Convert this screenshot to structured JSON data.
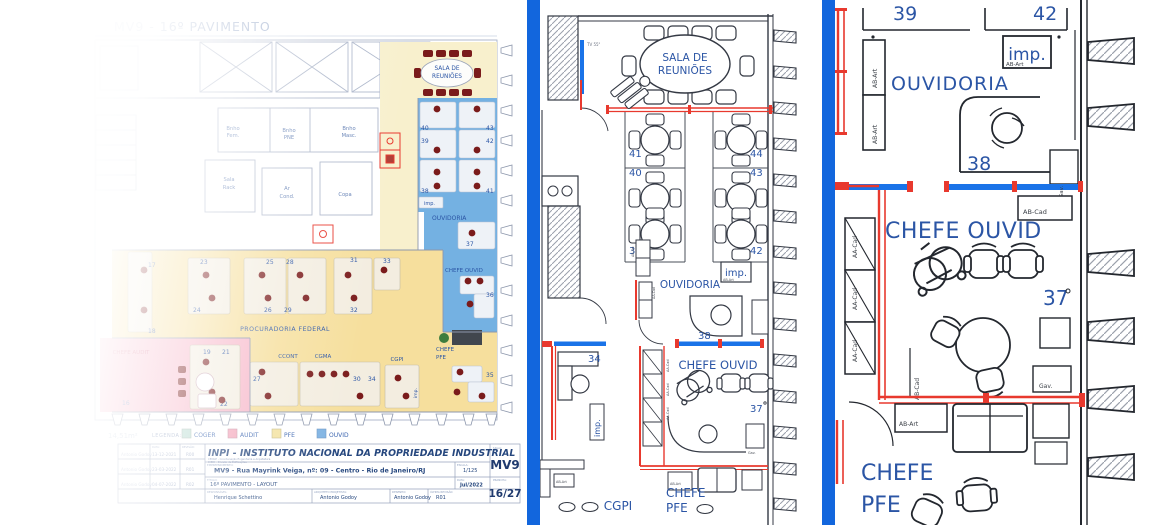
{
  "colors": {
    "divider": "#1266dd",
    "wall_red": "#e8392e",
    "glass_blue": "#1a73e8",
    "text_blue": "#2b55a5",
    "zone_ouvid": "#74b1e2",
    "zone_pfe": "#f6df9d",
    "zone_audit": "#f7b7c9",
    "zone_cream": "#f8f0cd",
    "chair_dark": "#7a1b1b"
  },
  "codes": {
    "imp": "imp.",
    "aa_cad": "AA-Cad",
    "ab_cad": "AB-Cad",
    "ab_art": "AB-Art",
    "gav": "Gav.",
    "tv": "TV 55\""
  },
  "left": {
    "header": "MV9 - 16º PAVIMENTO",
    "labels": {
      "sala_reunioes_1": "SALA DE",
      "sala_reunioes_2": "REUNIÕES",
      "bnho_fem_1": "Bnho",
      "bnho_fem_2": "Fem.",
      "bnho_pne_1": "Bnho",
      "bnho_pne_2": "PNE",
      "bnho_masc_1": "Bnho",
      "bnho_masc_2": "Masc.",
      "sala_rack_1": "Sala",
      "sala_rack_2": "Rack",
      "ar_cond_1": "Ar",
      "ar_cond_2": "Cond.",
      "copa": "Copa",
      "ouvidoria": "OUVIDORIA",
      "chefe_ouvid": "CHEFE OUVID",
      "procuradoria": "PROCURADORIA FEDERAL",
      "ccont": "CCONT",
      "cgma": "CGMA",
      "cgpi": "CGPI",
      "chefe_pfe_1": "CHEFE",
      "chefe_pfe_2": "PFE",
      "chefe_audit": "CHEFE AUDIT",
      "area_note": "14,51m²"
    },
    "nums": {
      "n16": "16",
      "n17": "17",
      "n18": "18",
      "n19": "19",
      "n20": "20",
      "n21": "21",
      "n22": "22",
      "n23": "23",
      "n24": "24",
      "n25": "25",
      "n26": "26",
      "n27": "27",
      "n28": "28",
      "n29": "29",
      "n30": "30",
      "n31": "31",
      "n32": "32",
      "n33": "33",
      "n34": "34",
      "n35": "35",
      "n36": "36",
      "n37": "37",
      "n38": "38",
      "n39": "39",
      "n40": "40",
      "n41": "41",
      "n42": "42",
      "n43": "43"
    },
    "legend": {
      "label": "LEGENDA:",
      "items": [
        {
          "name": "COGER",
          "color": "#b9dcd2"
        },
        {
          "name": "AUDIT",
          "color": "#f4a7bb"
        },
        {
          "name": "PFE",
          "color": "#f3e3a2"
        },
        {
          "name": "OUVID",
          "color": "#7fb3e3"
        }
      ]
    },
    "titleblock": {
      "org": "INPI - INSTITUTO NACIONAL DA PROPRIEDADE INDUSTRIAL",
      "org_sub1": "CENGE - Coordenação Engenharia e Arquitetura",
      "org_sub2": "DIEDI - Divisão de Edificações",
      "empreendimento_label": "EMPREENDIMENTO:",
      "empreendimento": "MV9 - Rua Mayrink Veiga, nº: 09 - Centro - Rio de Janeiro/RJ",
      "titulo_label": "TÍTULO:",
      "titulo": "16º PAVIMENTO - LAYOUT",
      "responsavel_label": "RESPONSÁVEL:",
      "responsavel": "Henrique Schettino",
      "arquiteto_label": "ARQUITETO PROJETISTA:",
      "arquiteto": "Antonio Godoy",
      "desenho_label": "DESENHO:",
      "desenho": "Antonio Godoy",
      "ultima_revisao_label": "ÚLTIMA REVISÃO:",
      "ultima_revisao": "R01",
      "sigla_label": "SIGLA:",
      "sigla": "MV9",
      "escala_label": "ESCALA:",
      "escala": "1/125",
      "data_label": "DATA:",
      "data": "Jul/2022",
      "prancha_label": "PRANCHA:",
      "prancha": "16/27",
      "rev_header_data": "DATA:",
      "rev_header_rev": "REVISÃO:",
      "revisions": [
        {
          "name": "Antonio Godoy",
          "date": "13-12-2021",
          "rev": "R00"
        },
        {
          "name": "Antonio Godoy",
          "date": "23-03-2022",
          "rev": "R01"
        },
        {
          "name": "Antonio Godoy",
          "date": "04-07-2022",
          "rev": "R02"
        }
      ]
    }
  },
  "middle": {
    "labels": {
      "sala_1": "SALA DE",
      "sala_2": "REUNIÕES",
      "ouvidoria": "OUVIDORIA",
      "chefe_ouvid": "CHEFE OUVID",
      "chefe_pfe_1": "CHEFE",
      "chefe_pfe_2": "PFE",
      "cgpi": "CGPI"
    },
    "nums": {
      "n34": "34",
      "n37": "37",
      "n38": "38",
      "n39": "39",
      "n40": "40",
      "n41": "41",
      "n42": "42",
      "n43": "43",
      "n44": "44"
    }
  },
  "right": {
    "labels": {
      "ouvidoria": "OUVIDORIA",
      "chefe_ouvid": "CHEFE OUVID",
      "chefe_pfe_1": "CHEFE",
      "chefe_pfe_2": "PFE"
    },
    "nums": {
      "n37": "37",
      "n38": "38",
      "n39": "39",
      "n42": "42"
    }
  }
}
